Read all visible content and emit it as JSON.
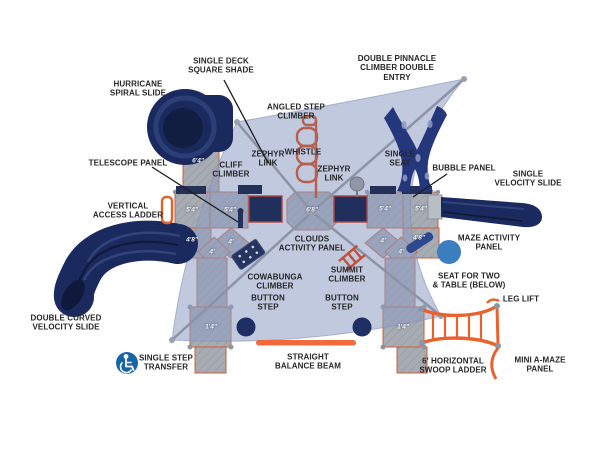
{
  "diagram_type": "playground-equipment-top-view-plan",
  "colors": {
    "background": "#ffffff",
    "shade_canopy": "#8e9cc2",
    "support_cable": "#8b93a4",
    "deck_gray": "#a7abb2",
    "deck_trim_orange": "#cf5c35",
    "navy_equipment": "#1b2a5e",
    "bright_orange": "#e8622d",
    "muted_red_climber": "#b5604e",
    "maze_panel_blue": "#3b7ec0",
    "transfer_icon_blue": "#1565a8",
    "label_text": "#262626",
    "height_text": "#f2f3f5"
  },
  "icons": {
    "single_step_transfer": "wheelchair-icon"
  },
  "labels": {
    "single_deck_square_shade": "SINGLE DECK\nSQUARE SHADE",
    "hurricane_spiral_slide": "HURRICANE\nSPIRAL SLIDE",
    "double_pinnacle_climber": "DOUBLE PINNACLE\nCLIMBER DOUBLE\nENTRY",
    "angled_step_climber": "ANGLED STEP\nCLIMBER",
    "zephyr_link_left": "ZEPHYR\nLINK",
    "cliff_climber": "CLIFF\nCLIMBER",
    "whistle": "WHISTLE",
    "single_seat": "SINGLE\nSEAT",
    "zephyr_link_right": "ZEPHYR\nLINK",
    "telescope_panel": "TELESCOPE PANEL",
    "bubble_panel": "BUBBLE PANEL",
    "single_velocity_slide": "SINGLE\nVELOCITY SLIDE",
    "vertical_access_ladder": "VERTICAL\nACCESS LADDER",
    "maze_activity_panel": "MAZE ACTIVITY\nPANEL",
    "clouds_activity_panel": "CLOUDS\nACTIVITY PANEL",
    "cowabunga_climber": "COWABUNGA\nCLIMBER",
    "summit_climber": "SUMMIT\nCLIMBER",
    "seat_for_two": "SEAT FOR TWO\n& TABLE (BELOW)",
    "leg_lift": "LEG LIFT",
    "button_step_left": "BUTTON\nSTEP",
    "button_step_right": "BUTTON\nSTEP",
    "double_curved_velocity_slide": "DOUBLE CURVED\nVELOCITY SLIDE",
    "single_step_transfer": "SINGLE STEP\nTRANSFER",
    "straight_balance_beam": "STRAIGHT\nBALANCE BEAM",
    "horizontal_swoop_ladder": "6' HORIZONTAL\nSWOOP LADDER",
    "mini_a_maze_panel": "MINI A-MAZE\nPANEL"
  },
  "heights": {
    "tower_6_4": "6'4\"",
    "left_outer_5_4": "5'4\"",
    "left_inner_5_4": "5'4\"",
    "center_6_8": "6'8\"",
    "right_inner_5_4": "5'4\"",
    "right_outer_5_4": "5'4\"",
    "left_4_8": "4'8\"",
    "left_4_a": "4'",
    "left_4_b": "4'",
    "right_4_a": "4'",
    "right_4_8": "4'8\"",
    "right_4_b": "4'",
    "left_1_4": "1'4\"",
    "right_1_4": "1'4\""
  }
}
